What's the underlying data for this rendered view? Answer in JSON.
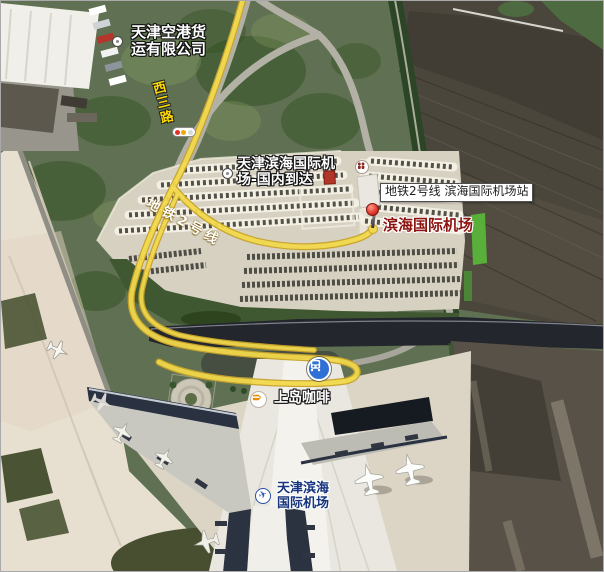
{
  "map": {
    "view": "satellite",
    "area": "天津滨海国际机场",
    "labels": {
      "cargo": {
        "line1": "天津空港货",
        "line2": "运有限公司"
      },
      "road": "西三路",
      "arrivals": {
        "line1": "天津滨海国际机",
        "line2": "场-国内到达"
      },
      "metro_banner": "地铁2号线",
      "station_tooltip": "地铁2号线 滨海国际机场站",
      "station_poi": "滨海国际机场",
      "coffee": "上岛咖啡",
      "terminal": {
        "line1": "天津滨海",
        "line2": "国际机场"
      }
    },
    "colors": {
      "metro_line_yellow": "#f2d94b",
      "metro_line_border": "#c8a32a",
      "pin_red": "#e23b30",
      "station_icon_blue": "#2f6fd6",
      "terminal_label_blue": "#16357e",
      "station_poi_maroon": "#8b1410",
      "road_label_yellow": "#ffd900"
    }
  }
}
